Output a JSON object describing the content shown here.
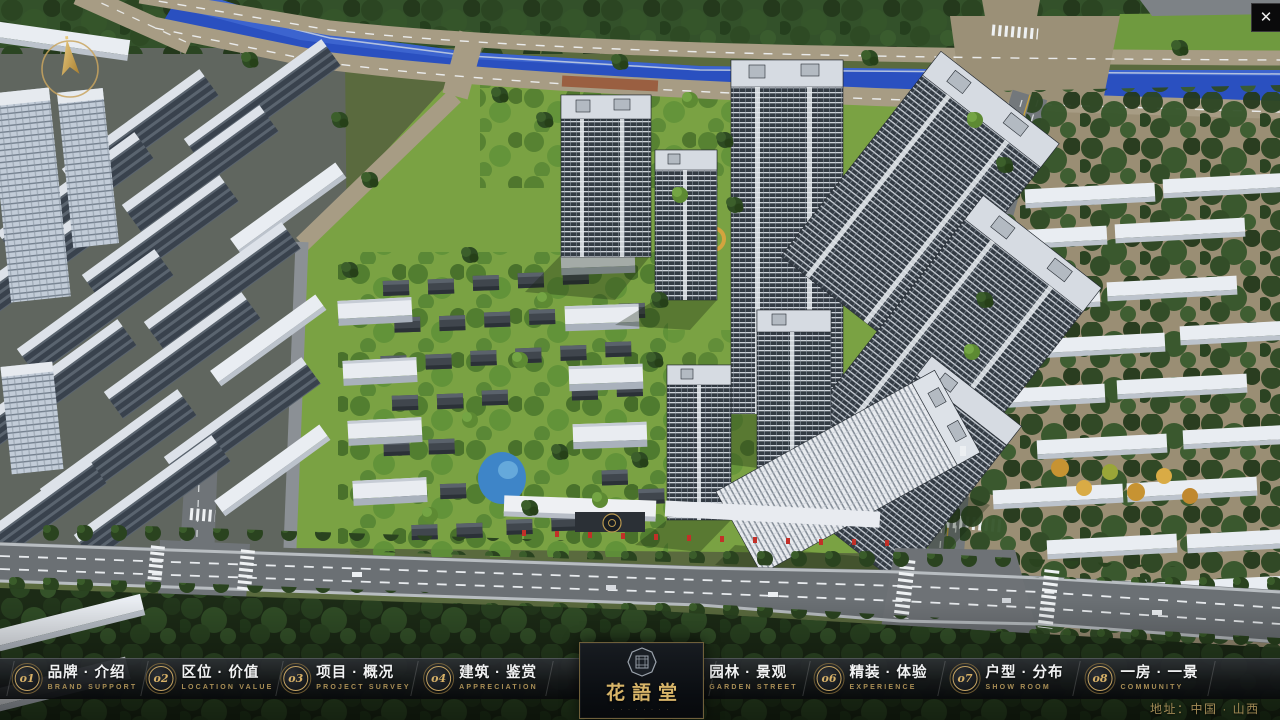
{
  "window": {
    "close_glyph": "✕"
  },
  "nav": {
    "items": [
      {
        "num": "o1",
        "zh": "品牌 · 介绍",
        "en": "BRAND SUPPORT"
      },
      {
        "num": "o2",
        "zh": "区位 · 价值",
        "en": "LOCATION VALUE"
      },
      {
        "num": "o3",
        "zh": "项目 · 概况",
        "en": "PROJECT SURVEY"
      },
      {
        "num": "o4",
        "zh": "建筑 · 鉴赏",
        "en": "APPRECIATION"
      },
      {
        "num": "o5",
        "zh": "园林 · 景观",
        "en": "GARDEN STREET"
      },
      {
        "num": "o6",
        "zh": "精装 · 体验",
        "en": "EXPERIENCE"
      },
      {
        "num": "o7",
        "zh": "户型 · 分布",
        "en": "SHOW ROOM"
      },
      {
        "num": "o8",
        "zh": "一房 · 一景",
        "en": "COMMUNITY"
      }
    ]
  },
  "logo": {
    "name": "花語堂",
    "tagline": "· · · · · · · ·"
  },
  "footer": {
    "address": "地址：中国 · 山西"
  },
  "colors": {
    "accent_gold": "#c9a45f",
    "bar_bg": "#101316",
    "river_blue": "#2a50c0"
  }
}
